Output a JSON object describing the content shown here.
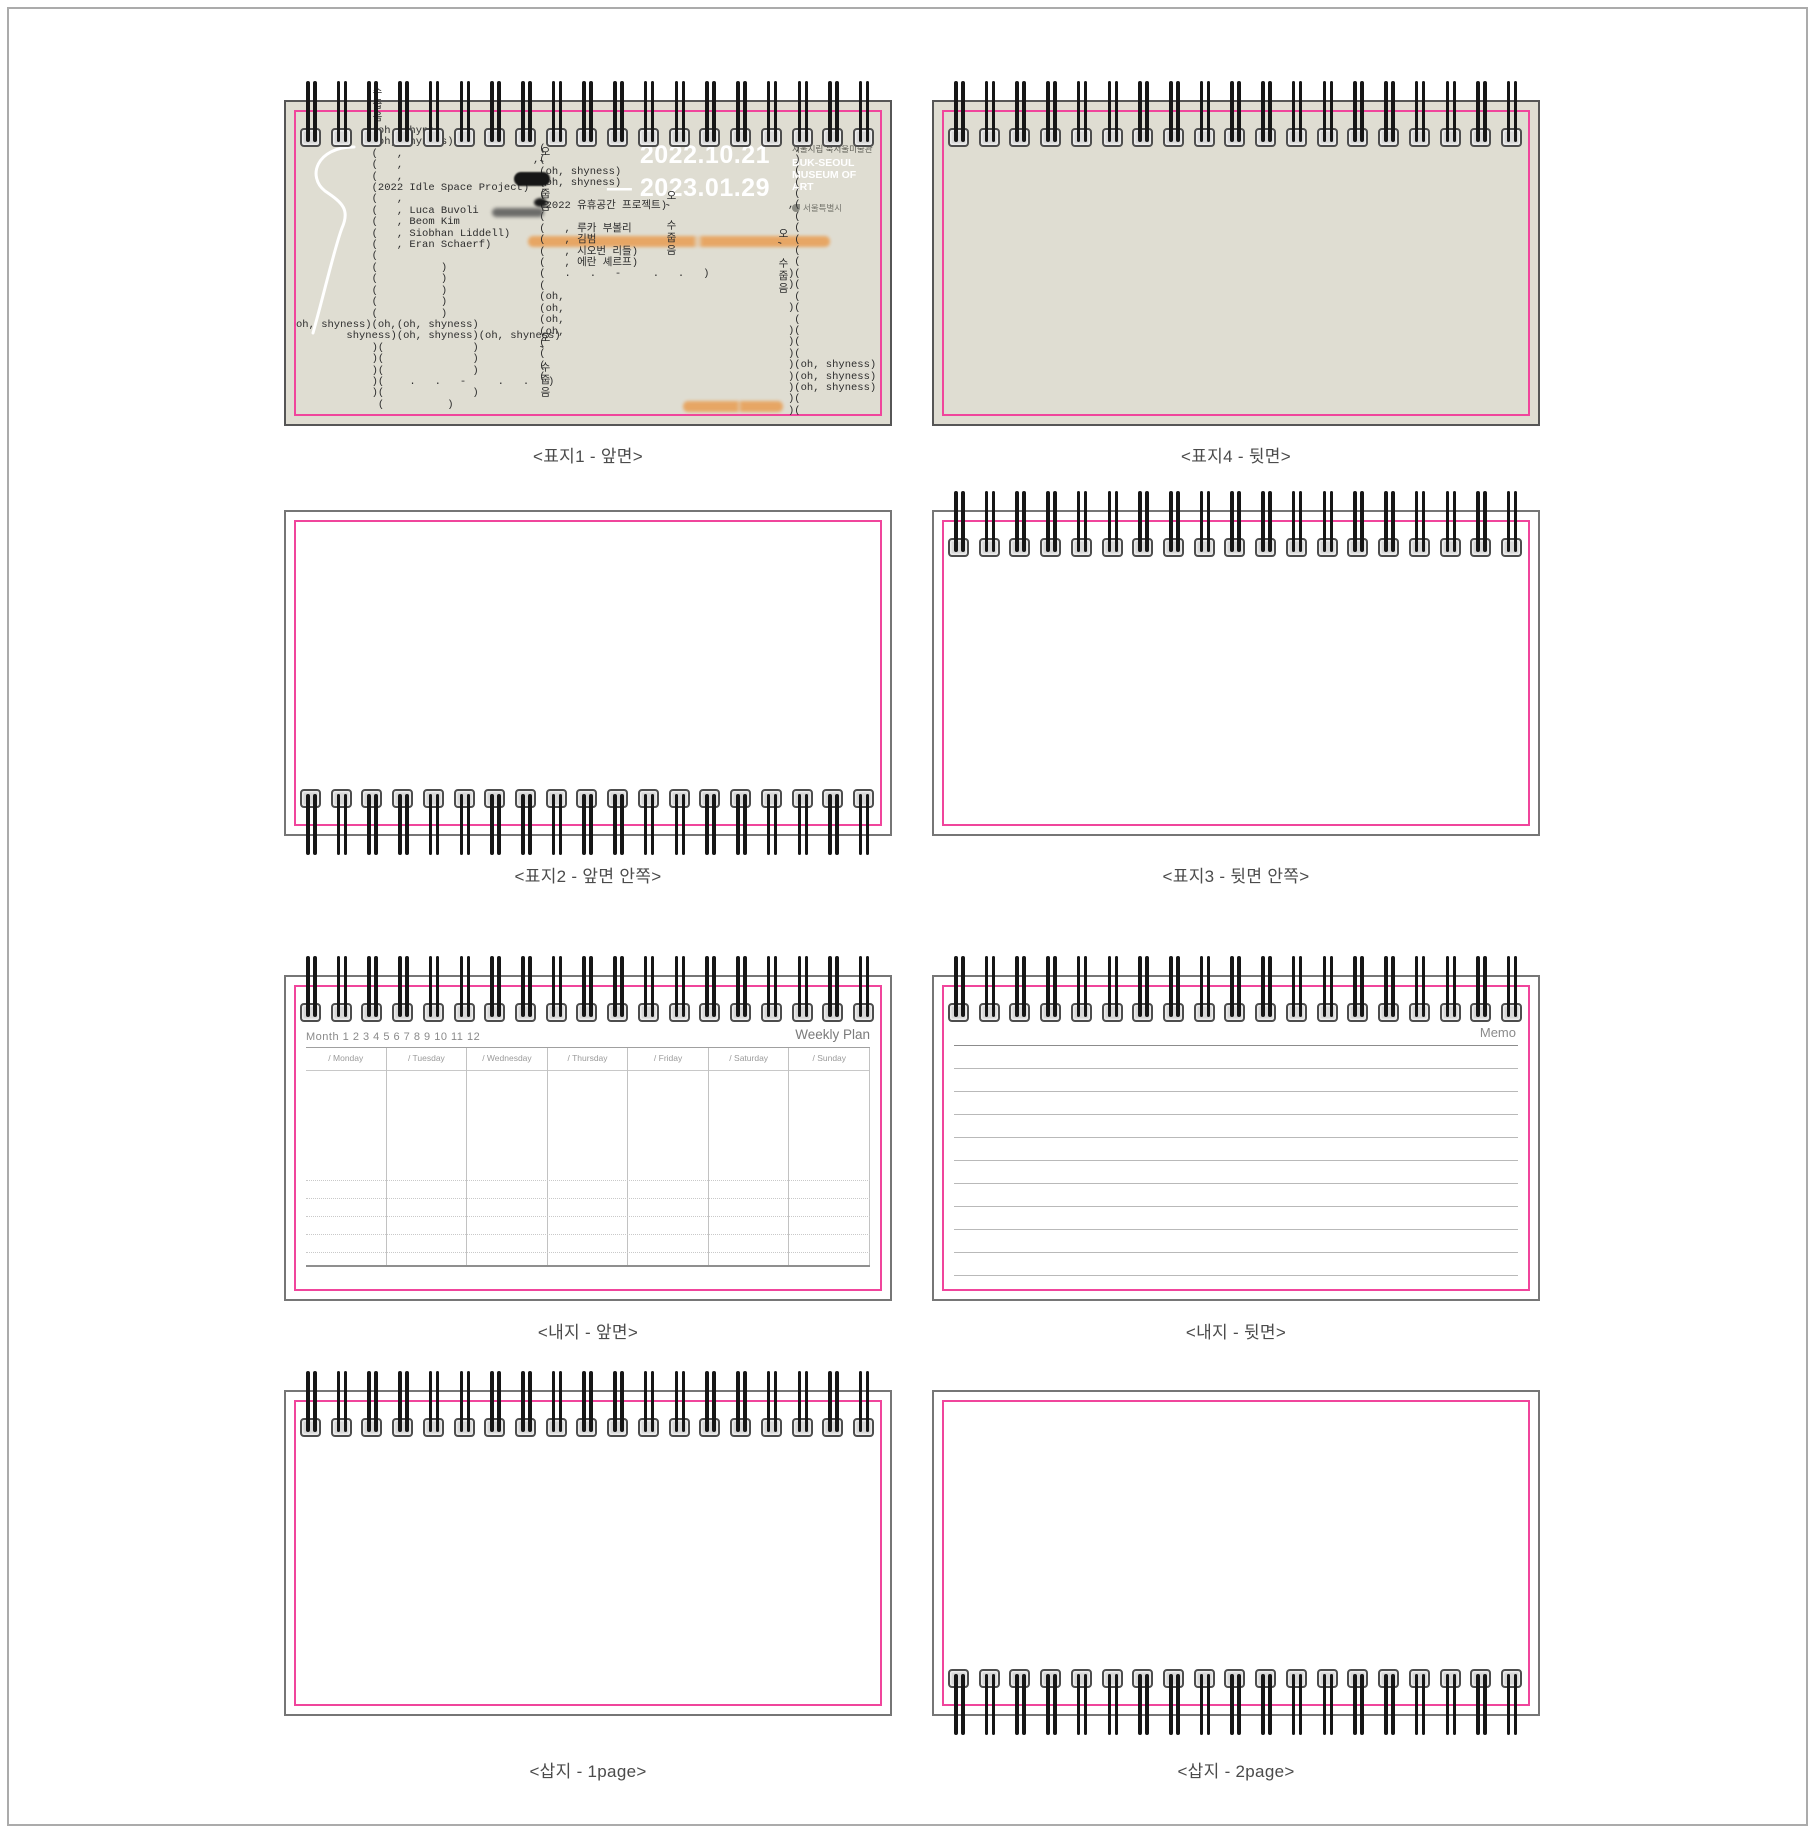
{
  "sheet": {
    "width": 1815,
    "height": 1833
  },
  "colors": {
    "beige": "#dfddd2",
    "pink": "#f0459c",
    "wire": "#161616",
    "clamp_fill": "#d8d8d8",
    "clamp_border": "#4d4d4d",
    "orange": "#e8a159",
    "caption": "#4b4b4b",
    "typewriter": "#2d2d2d",
    "muted": "#8a8a8a",
    "line_light": "#c6c6c6",
    "line_mid": "#9a9a9a",
    "memo_line": "#b9b9b9",
    "date_white": "#ffffff"
  },
  "spiral": {
    "units_per_panel": 19
  },
  "panels": [
    {
      "caption": "<표지1 - 앞면>"
    },
    {
      "caption": "<표지4 - 뒷면>"
    },
    {
      "caption": "<표지2 - 앞면 안쪽>"
    },
    {
      "caption": "<표지3 - 뒷면 안쪽>"
    },
    {
      "caption": "<내지 - 앞면>"
    },
    {
      "caption": "<내지 - 뒷면>"
    },
    {
      "caption": "<삽지 - 1page>"
    },
    {
      "caption": "<삽지 - 2page>"
    }
  ],
  "cover1": {
    "date_line1": "2022.10.21",
    "date_line2": "— 2023.01.29",
    "museum_kr": "서울시립 북서울미술관",
    "museum_en1": "BUK-SEOUL",
    "museum_en2": "MUSEUM OF ART",
    "city_name": "서울특별시",
    "left_lines": [
      "            (oh, shynes",
      "            (oh, shyness)",
      "            (   ,",
      "            (   ,",
      "            (   ,",
      "            (2022 Idle Space Project)",
      "            (   ,",
      "            (   , Luca Buvoli",
      "            (   , Beom Kim",
      "            (   , Siobhan Liddell)",
      "            (   , Eran Schaerf)",
      "            (",
      "            (          )",
      "            (          )",
      "            (          )",
      "            (          )",
      "            (          )",
      "oh, shyness)(oh,(oh, shyness)",
      "        shyness)(oh, shyness)(oh, shyness)",
      "            )(              )",
      "            )(              )",
      "            )(              )",
      "            )(    .   .   -     .   .   )",
      "            )(              )",
      "             (          )"
    ],
    "right_lines": [
      " (",
      ",(",
      " (oh, shyness)",
      " (oh, shyness)",
      " (",
      " (2022 유휴공간 프로젝트)",
      " (",
      " (   , 루카 부볼리",
      " (   , 김범",
      " (   , 시오번 리들)",
      " (   , 에란 셰르프)",
      " (   .   .   -     .   .   )",
      " (",
      " (oh,",
      " (oh,",
      " (oh,",
      " (oh,",
      " (",
      " (",
      " (",
      " ("
    ],
    "far_right_lines": [
      " )",
      " )",
      " )",
      " (",
      " (",
      " (",
      ",(",
      " (",
      " (",
      " (",
      " (",
      " (",
      ")(",
      ")(",
      " (",
      ")(",
      " (",
      ")(",
      ")(",
      ")(",
      ")(oh, shyness)",
      ")(oh, shyness)",
      ")(oh, shyness)",
      ")(",
      ")("
    ],
    "vertical_texts": [
      {
        "text": "수줍음",
        "x": 84,
        "y": -16
      },
      {
        "text": "오, 수줍음",
        "x": 252,
        "y": 44
      },
      {
        "text": "오, 수줍음",
        "x": 252,
        "y": 230
      },
      {
        "text": "오, 수줍음",
        "x": 378,
        "y": 88
      },
      {
        "text": "오, 수줍음",
        "x": 490,
        "y": 126
      }
    ]
  },
  "weekly": {
    "month_label": "Month",
    "month_numbers": [
      "1",
      "2",
      "3",
      "4",
      "5",
      "6",
      "7",
      "8",
      "9",
      "10",
      "11",
      "12"
    ],
    "title": "Weekly Plan",
    "days": [
      "/ Monday",
      "/ Tuesday",
      "/ Wednesday",
      "/ Thursday",
      "/ Friday",
      "/ Saturday",
      "/ Sunday"
    ],
    "dotted_row_count": 5
  },
  "memo": {
    "title": "Memo",
    "line_count": 11
  }
}
